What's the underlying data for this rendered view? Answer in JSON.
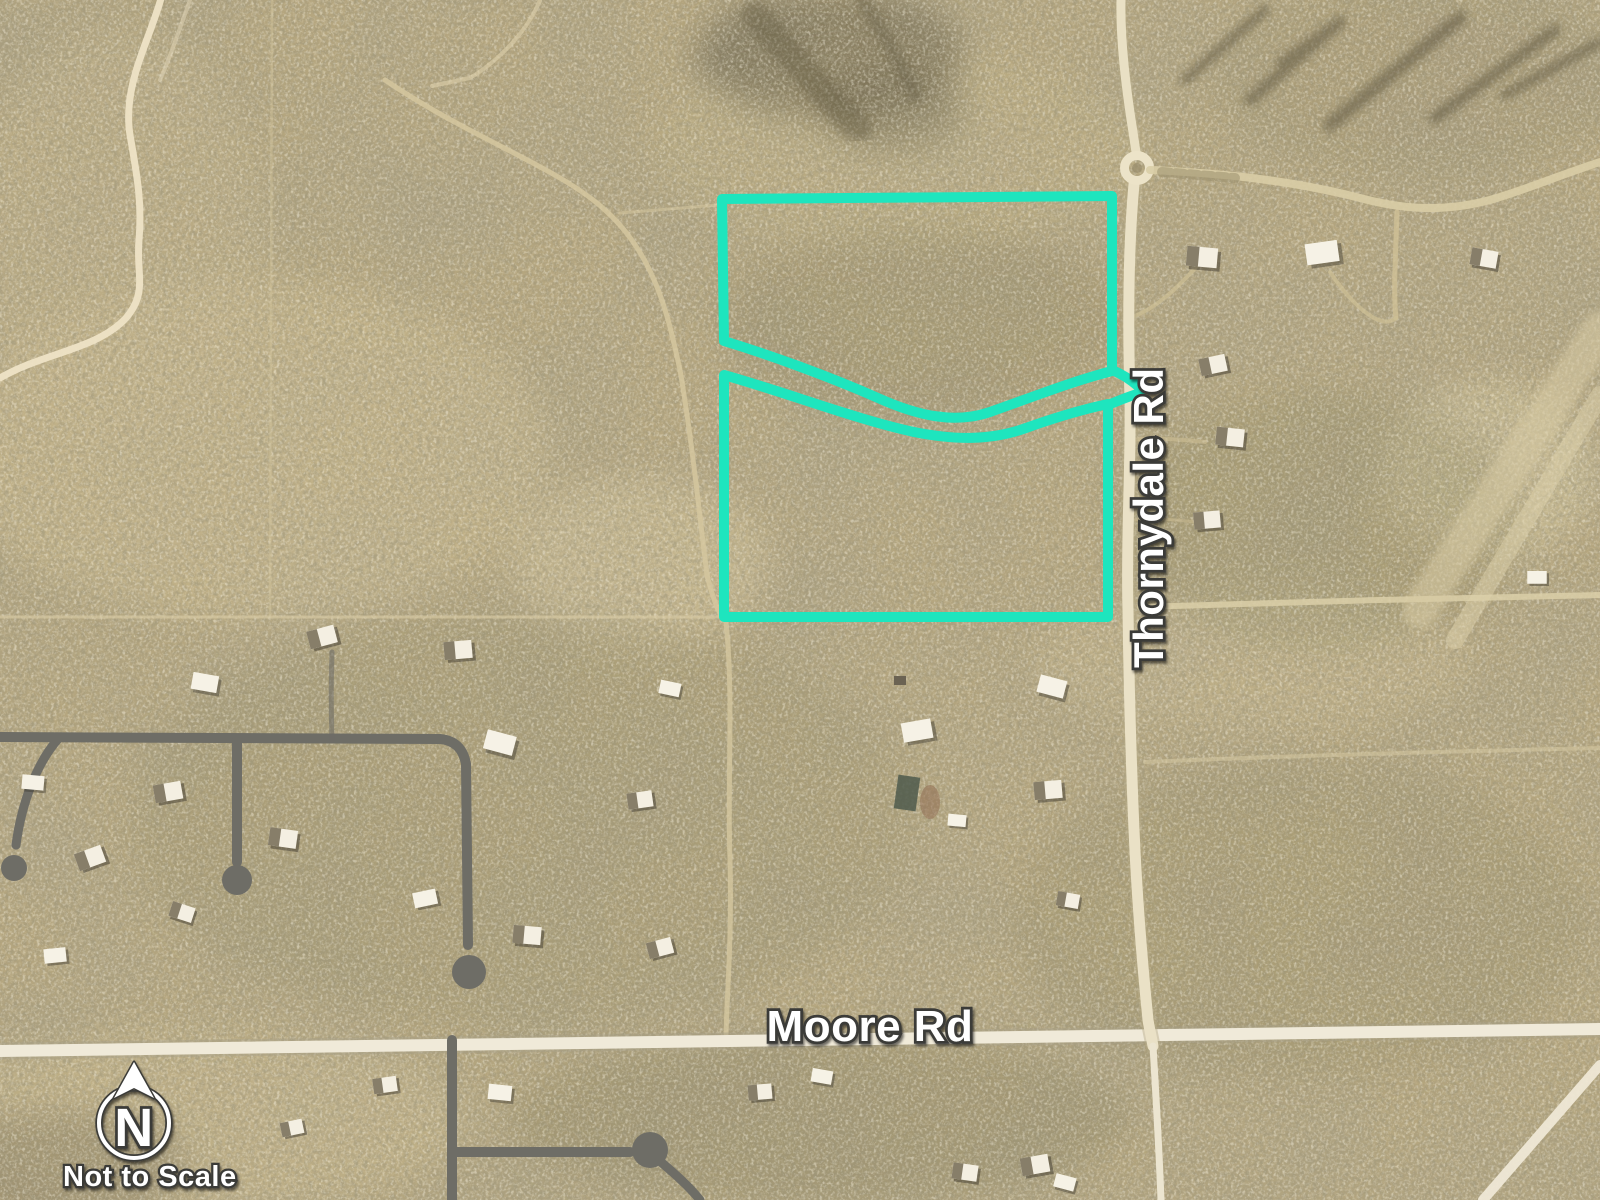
{
  "map": {
    "road_labels": {
      "vertical_road": "Thornydale Rd",
      "horizontal_road": "Moore Rd"
    },
    "compass": {
      "north_letter": "N",
      "scale_note": "Not to Scale"
    },
    "parcel_annotation": {
      "outline_color": "#1EE5BE",
      "upper_parcel_path": "M722,199 L1112,196 L1112,371 C1070,382 1030,398 990,412 C955,424 918,416 878,398 C828,376 770,355 724,341 Z",
      "lower_parcel_path": "M724,375 C788,393 858,420 914,432 C954,440 990,441 1026,428 C1054,418 1080,410 1108,404 L1108,617 L724,617 Z",
      "upper_road_spur_path": "M1112,370 C1122,374 1131,380 1139,387",
      "lower_road_spur_path": "M1108,405 C1120,400 1130,396 1140,393"
    }
  }
}
